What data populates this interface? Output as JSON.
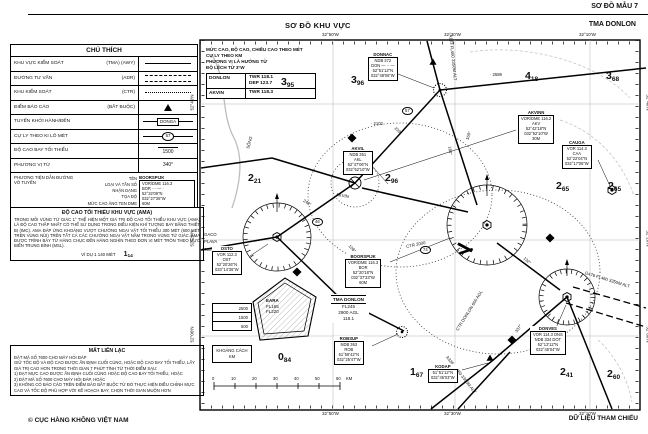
{
  "header": {
    "sample_label": "SƠ ĐỒ MẪU 7",
    "title": "SƠ ĐỒ KHU VỰC",
    "chart_name": "TMA DONLON"
  },
  "footer": {
    "left": "© CỤC HÀNG KHÔNG VIỆT NAM",
    "right": "DỮ LIỆU THAM CHIẾU"
  },
  "legend": {
    "title": "CHÚ THÍCH",
    "rows": [
      {
        "label": "KHU VỰC KIỂM SOÁT",
        "code": "(TMA) (AWY)"
      },
      {
        "label": "ĐƯỜNG TƯ VẤN",
        "code": "(ADR)"
      },
      {
        "label": "KHU KIỂM SOÁT",
        "code": "(CTR)"
      },
      {
        "label": "ĐIỂM BÁO CÁO",
        "code": "(BẮT BUỘC)"
      },
      {
        "label": "TUYẾN KHỞI HÀNH/ĐẾN",
        "code": "",
        "symbol_text": "DONGA"
      },
      {
        "label": "CỰ LY THEO KI LÔ MÉT",
        "code": "",
        "symbol_text": "57"
      },
      {
        "label": "ĐỘ CAO BAY TỐI THIỂU",
        "code": "",
        "symbol_text": "1500"
      },
      {
        "label": "PHƯƠNG VỊ TỪ",
        "code": "",
        "symbol_text": "340°"
      }
    ],
    "navaid_legend": {
      "label": "PHƯƠNG TIỆN DẪN ĐƯỜNG VÔ TUYẾN",
      "fields": "TÊN\nLOẠI VÀ TẦN SỐ\nNHẬN DẠNG\nTỌA ĐỘ\nMỨC CAO ĂNG TEN DME",
      "example_name": "BOORSPIJK",
      "example_body": "VOR/DME 116.3\nBOR ··· — ·\n52°32'09\"N\n032°27'35\"W\n60M"
    }
  },
  "ama_note": {
    "title": "ĐỘ CAO TỐI THIỂU KHU VỰC (AMA)",
    "body": "TRONG MỖI VÙNG TỨ GIÁC 1° THỂ HIỆN MỘT GIÁ TRỊ ĐỘ CAO TỐI THIỂU KHU VỰC (AMA) LÀ ĐỘ CAO THẤP NHẤT CÓ THỂ SỬ DỤNG TRONG ĐIỀU KIỆN KHÍ TƯỢNG BAY BẰNG THIẾT BỊ (IMC). AMA ĐÁP ỨNG KHOẢNG VƯỢT CHƯỚNG NGẠI VẬT TỐI THIỂU 300 MÉT (600 MÉT TRÊN VÙNG NÚI) TRÊN TẤT CẢ CÁC CHƯỚNG NGẠI VẬT NẰM TRONG VÙNG TỨ GIÁC. AMA ĐƯỢC TRÌNH BÀY TỪ HÀNG CHỤC ĐẾN HÀNG NGHÌN THEO ĐƠN VỊ MÉT TRÒN THEO MỰC BIỂN TRUNG BÌNH (MSL).",
    "example_label": "VÍ DỤ 1 140 MÉT",
    "example_main": "1",
    "example_sub": "14"
  },
  "lost_comm": {
    "title": "MẤT LIÊN LẠC",
    "lines": [
      {
        "t": "ĐẶT MÃ SỐ 7600 CHO MÁY HỎI ĐÁP"
      },
      {
        "t": "GIỮ TỐC ĐỘ VÀ ĐỘ CAO ĐƯỢC ẤN ĐỊNH CUỐI CÙNG, HOẶC ĐỘ CAO BAY TỐI THIỂU, LẤY GIÁ TRỊ CAO HƠN TRONG THỜI GIAN 7 PHÚT TÍNH TỪ THỜI ĐIỂM SAU:"
      },
      {
        "t": "1) ĐẠT MỰC CAO ĐƯỢC ẤN ĐỊNH CUỐI CÙNG HOẶC ĐỘ CAO BAY TỐI THIỂU, HOẶC"
      },
      {
        "t": "2) ĐẶT MÃ SỐ 7600 CHO MÁY HỎI ĐÁP, HOẶC"
      },
      {
        "t": "3) KHÔNG CÓ BÁO CÁO TRÊN ĐIỂM BÁO BẮT BUỘC TỪ ĐÓ THỰC HIỆN ĐIỀU CHỈNH MỰC CAO VÀ TỐC ĐỘ PHÙ HỢP VỚI KẾ HOẠCH BAY; CHỌN THỜI GIAN MUỘN HƠN"
      }
    ]
  },
  "chart": {
    "info_lines": [
      {
        "t": "MỨC CAO, ĐỘ CAO, CHIỀU CAO THEO MÉT"
      },
      {
        "t": "CỰ LY THEO KM"
      },
      {
        "t": "PHƯƠNG VỊ LÀ HƯỚNG TỪ"
      },
      {
        "t": "ĐỘ LỆCH TỪ 3°W"
      }
    ],
    "freqs": [
      {
        "name": "DONLON",
        "f1": "TWR 118.1",
        "f2": "DEP 123.7"
      },
      {
        "name": "AKVIN",
        "f1": "TWR 118.3",
        "f2": ""
      }
    ],
    "tma_box": {
      "l1": "TMA DONLON",
      "l2": "FL245",
      "l3": "2900 AGL",
      "l4": "118.1"
    },
    "restricted": {
      "name": "EARA",
      "upper": "FL165",
      "lower": "FL220"
    },
    "elev_rows": [
      {
        "t": "2500"
      },
      {
        "t": "1500"
      },
      {
        "t": "500"
      }
    ],
    "scale_box": {
      "line1": "KHOẢNG CÁCH",
      "line2": "KM"
    },
    "scale_ticks": [
      {
        "x": 212,
        "y": 376,
        "t": "0"
      },
      {
        "x": 231,
        "y": 376,
        "t": "10"
      },
      {
        "x": 252,
        "y": 376,
        "t": "20"
      },
      {
        "x": 273,
        "y": 376,
        "t": "30"
      },
      {
        "x": 294,
        "y": 376,
        "t": "40"
      },
      {
        "x": 315,
        "y": 376,
        "t": "50"
      },
      {
        "x": 336,
        "y": 376,
        "t": "60"
      },
      {
        "x": 346,
        "y": 376,
        "t": "KM"
      }
    ],
    "ama_values": [
      {
        "x": 281,
        "y": 72,
        "main": "3",
        "sub": "95"
      },
      {
        "x": 351,
        "y": 70,
        "main": "3",
        "sub": "96"
      },
      {
        "x": 525,
        "y": 66,
        "main": "4",
        "sub": "18"
      },
      {
        "x": 606,
        "y": 66,
        "main": "3",
        "sub": "68"
      },
      {
        "x": 248,
        "y": 168,
        "main": "2",
        "sub": "21"
      },
      {
        "x": 385,
        "y": 168,
        "main": "2",
        "sub": "96"
      },
      {
        "x": 556,
        "y": 176,
        "main": "2",
        "sub": "65"
      },
      {
        "x": 608,
        "y": 176,
        "main": "2",
        "sub": "65"
      },
      {
        "x": 278,
        "y": 347,
        "main": "0",
        "sub": "84"
      },
      {
        "x": 410,
        "y": 362,
        "main": "1",
        "sub": "67"
      },
      {
        "x": 560,
        "y": 362,
        "main": "2",
        "sub": "41"
      },
      {
        "x": 607,
        "y": 364,
        "main": "2",
        "sub": "60"
      }
    ],
    "navaids": [
      {
        "x": 368,
        "y": 52,
        "name": "DONNAC",
        "body": "NDB 372\nDON — ·· —\n52°51'12\"N\n032°48'06\"W"
      },
      {
        "x": 343,
        "y": 146,
        "name": "AKVIL",
        "body": "NDB 351\nAKL\n52°47'06\"N\n032°52'10\"W"
      },
      {
        "x": 518,
        "y": 110,
        "name": "AKVINN",
        "body": "VOR/DME 116.2\nAKV\n52°42'18\"N\n032°52'10\"W\n30M"
      },
      {
        "x": 562,
        "y": 140,
        "name": "CAUGA",
        "body": "VOR 114.3\nCAA\n52°22'04\"N\n032°17'05\"W"
      },
      {
        "x": 212,
        "y": 246,
        "name": "OSTO",
        "body": "VOR 112.3\nOST\n52°20'26\"N\n033°14'36\"W"
      },
      {
        "x": 345,
        "y": 254,
        "name": "BOORSPIJK",
        "body": "VOR/DME 116.3\nBOR\n52°20'18\"N\n032°37'33\"W\n60M"
      },
      {
        "x": 334,
        "y": 336,
        "name": "ROBSUP",
        "body": "NDB 363\nROB\n51°59'42\"N\n032°25'47\"W"
      },
      {
        "x": 530,
        "y": 326,
        "name": "DONVES",
        "body": "VOR 114.3 DNS\nNDB 334 DOT\n52°13'12\"N\n032°45'04\"W"
      },
      {
        "x": 428,
        "y": 364,
        "name": "KODAP",
        "body": "51°51'12\"N\n032°45'03\"W"
      }
    ],
    "bearings": [
      {
        "x": 394,
        "y": 128,
        "rot": 42,
        "t": "239°"
      },
      {
        "x": 446,
        "y": 148,
        "rot": 83,
        "t": "184°"
      },
      {
        "x": 464,
        "y": 133,
        "rot": -72,
        "t": "160°"
      },
      {
        "x": 303,
        "y": 200,
        "rot": 33,
        "t": "240°"
      },
      {
        "x": 523,
        "y": 258,
        "rot": 41,
        "t": "132°"
      },
      {
        "x": 514,
        "y": 326,
        "rot": -56,
        "t": "337°"
      },
      {
        "x": 348,
        "y": 246,
        "rot": 46,
        "t": "108°"
      }
    ],
    "distances": [
      {
        "x": 402,
        "y": 107,
        "t": "57"
      },
      {
        "x": 420,
        "y": 246,
        "t": "74"
      },
      {
        "x": 312,
        "y": 218,
        "t": "46"
      }
    ],
    "spots": [
      {
        "x": 490,
        "y": 72,
        "t": "· 2589"
      },
      {
        "x": 371,
        "y": 121,
        "t": "· 2102"
      }
    ],
    "route_labels": [
      {
        "x": 430,
        "y": 55,
        "rot": 84,
        "t": "A123 FL460 3350M ALT"
      },
      {
        "x": 584,
        "y": 277,
        "rot": 17,
        "t": "G476 FL460 3350M ALT"
      },
      {
        "x": 438,
        "y": 372,
        "rot": 52,
        "t": "A326 FL460 3350M ALT"
      },
      {
        "x": 204,
        "y": 232,
        "rot": 0,
        "t": "GACO"
      },
      {
        "x": 204,
        "y": 239,
        "rot": 0,
        "t": "PLAVA"
      },
      {
        "x": 202,
        "y": 247,
        "rot": 0,
        "t": "700M ALT"
      },
      {
        "x": 336,
        "y": 193,
        "rot": 10,
        "t": "AKVIN"
      },
      {
        "x": 446,
        "y": 308,
        "rot": -58,
        "t": "CTR DONLON 600 AGL"
      },
      {
        "x": 406,
        "y": 242,
        "rot": -12,
        "t": "CTR 2000"
      },
      {
        "x": 243,
        "y": 140,
        "rot": -75,
        "t": "SÔNG"
      }
    ],
    "edge_labels": [
      {
        "x": 322,
        "y": 32,
        "rot": 0,
        "t": "32°50'W"
      },
      {
        "x": 444,
        "y": 32,
        "rot": 0,
        "t": "32°30'W"
      },
      {
        "x": 579,
        "y": 32,
        "rot": 0,
        "t": "32°10'W"
      },
      {
        "x": 322,
        "y": 411,
        "rot": 0,
        "t": "32°50'W"
      },
      {
        "x": 444,
        "y": 411,
        "rot": 0,
        "t": "32°30'W"
      },
      {
        "x": 579,
        "y": 411,
        "rot": 0,
        "t": "32°10'W"
      },
      {
        "x": 184,
        "y": 100,
        "rot": -90,
        "t": "52°40'N"
      },
      {
        "x": 184,
        "y": 236,
        "rot": -90,
        "t": "52°20'N"
      },
      {
        "x": 184,
        "y": 332,
        "rot": -90,
        "t": "52°00'N"
      },
      {
        "x": 640,
        "y": 100,
        "rot": 90,
        "t": "52°40'N"
      },
      {
        "x": 640,
        "y": 236,
        "rot": 90,
        "t": "52°20'N"
      },
      {
        "x": 640,
        "y": 332,
        "rot": 90,
        "t": "52°00'N"
      }
    ]
  }
}
